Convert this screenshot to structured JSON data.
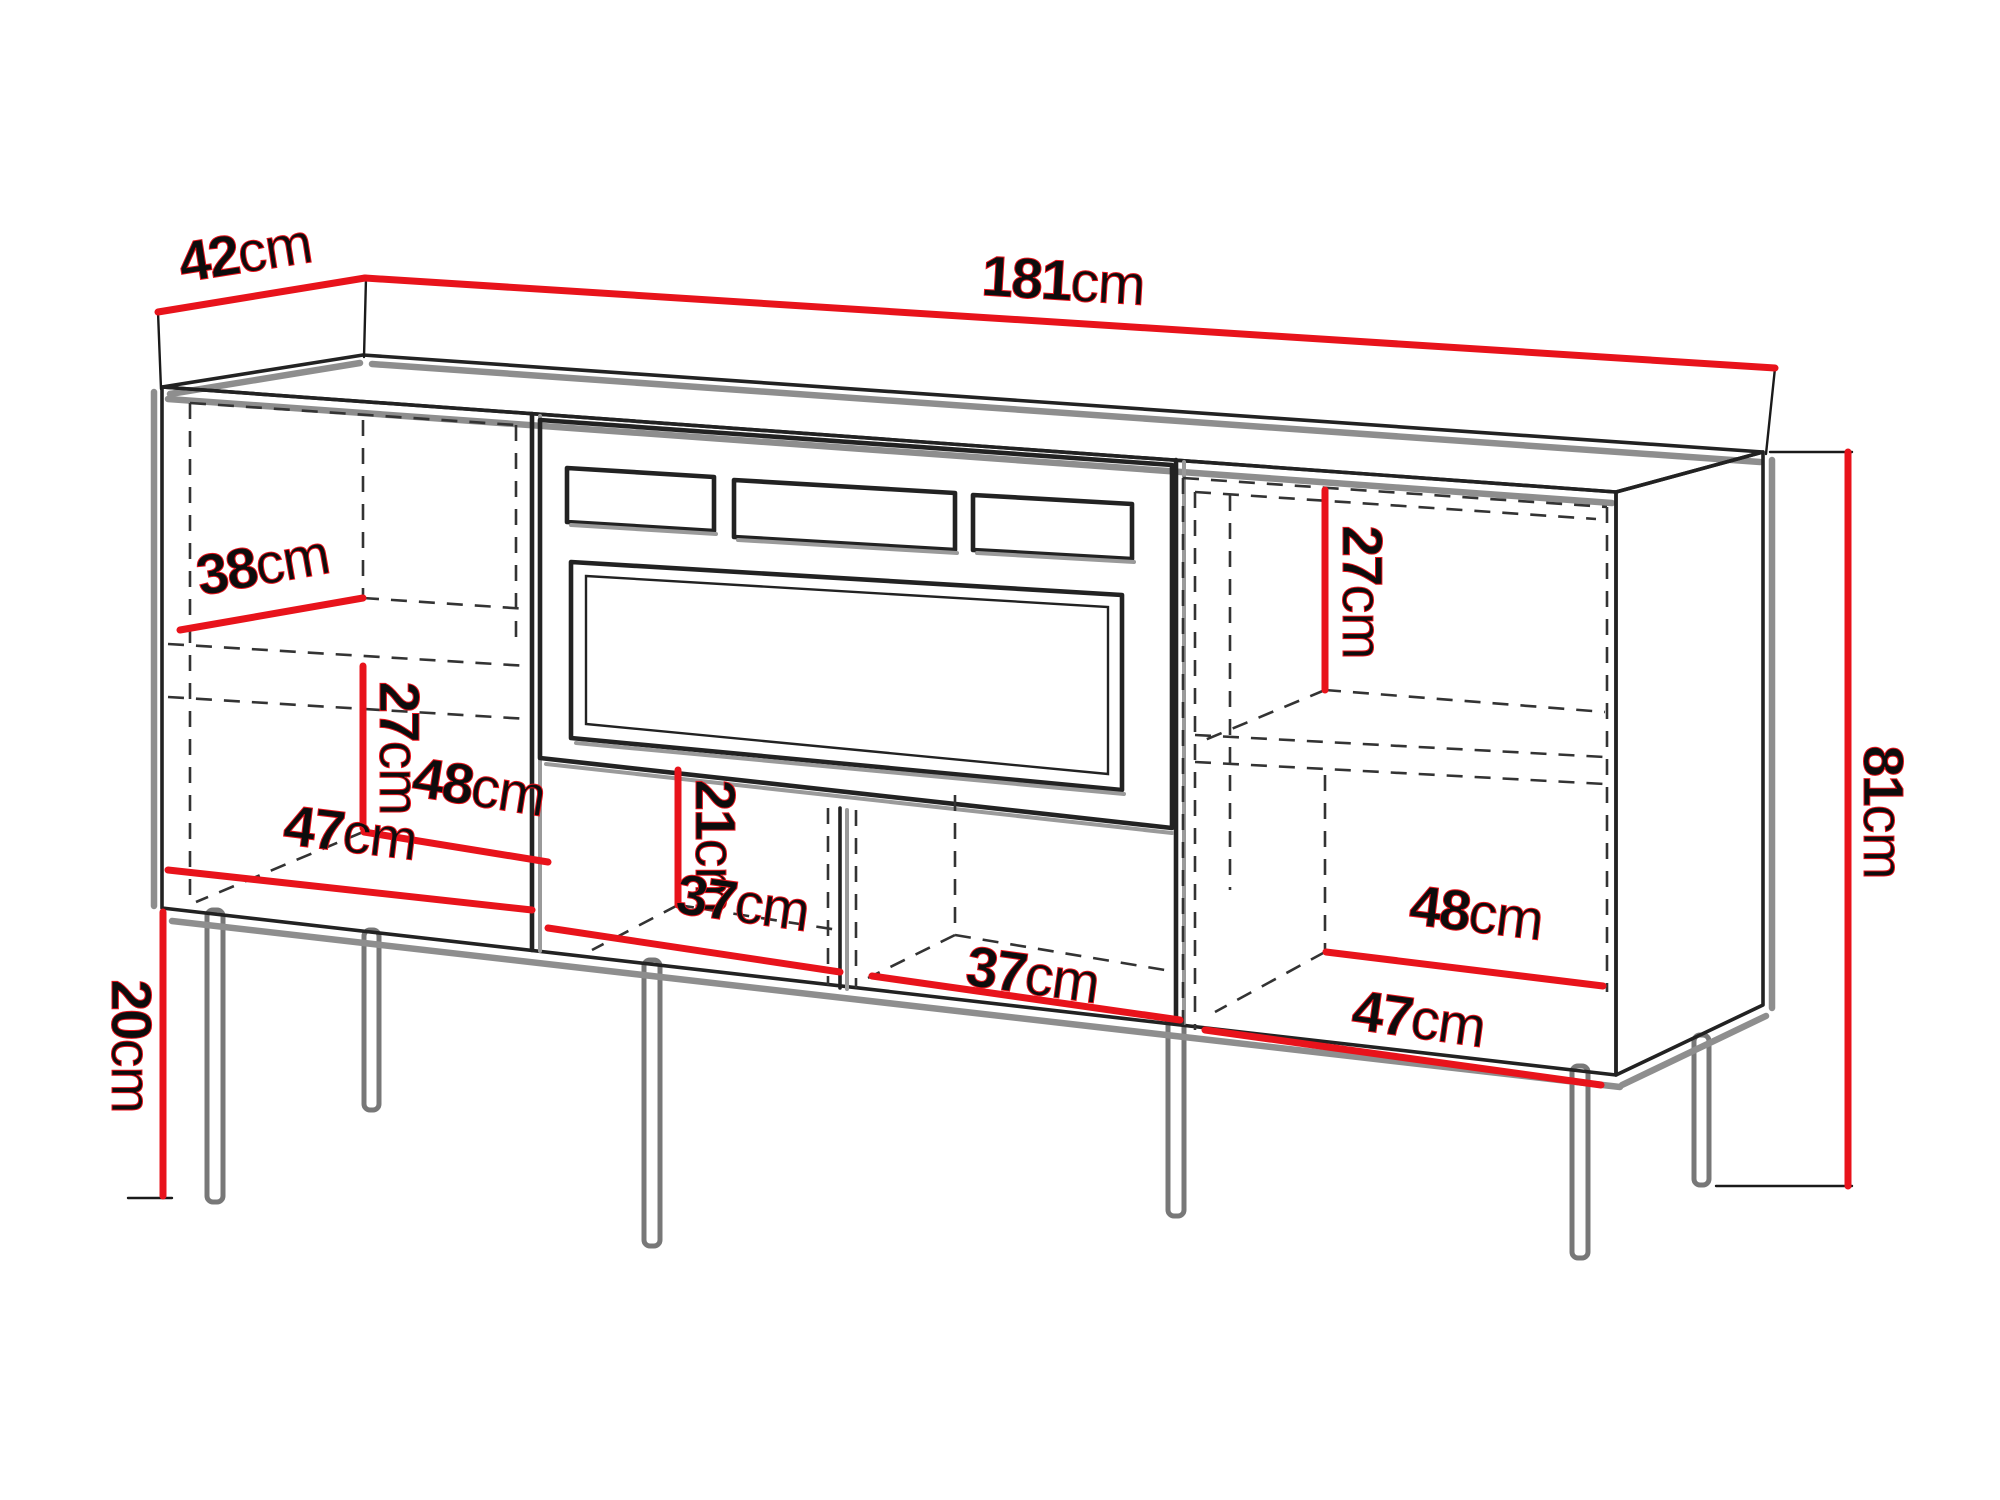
{
  "diagram": {
    "title": "Furniture dimension diagram",
    "furniture": "TV cabinet / sideboard with fireplace recess, two side cabinets, open shelves and six legs",
    "unit": "cm",
    "colors": {
      "dimension_line": "#e8131b",
      "outline": "#222222",
      "shadow": "#8e8e8e",
      "dashed": "#333333",
      "text": "#0d0d0d",
      "background": "#ffffff"
    },
    "dimensions": {
      "depth": {
        "number": "42",
        "unit": "cm",
        "meaning": "overall depth (top left edge)"
      },
      "width": {
        "number": "181",
        "unit": "cm",
        "meaning": "overall width (top edge)"
      },
      "height": {
        "number": "81",
        "unit": "cm",
        "meaning": "overall height (right side)"
      },
      "leg_height": {
        "number": "20",
        "unit": "cm",
        "meaning": "leg height (bottom left)"
      },
      "left_shelf_depth": {
        "number": "38",
        "unit": "cm",
        "meaning": "left cabinet shelf depth"
      },
      "left_lower_height": {
        "number": "27",
        "unit": "cm",
        "meaning": "left cabinet lower compartment height"
      },
      "left_lower_width": {
        "number": "48",
        "unit": "cm",
        "meaning": "left cabinet lower compartment width"
      },
      "left_floor_depth": {
        "number": "47",
        "unit": "cm",
        "meaning": "left cabinet floor depth"
      },
      "middle_lower_height": {
        "number": "21",
        "unit": "cm",
        "meaning": "middle open shelf height"
      },
      "middle_left_width": {
        "number": "37",
        "unit": "cm",
        "meaning": "middle left open shelf width"
      },
      "middle_right_width": {
        "number": "37",
        "unit": "cm",
        "meaning": "middle right open shelf width"
      },
      "right_upper_height": {
        "number": "27",
        "unit": "cm",
        "meaning": "right cabinet upper compartment height"
      },
      "right_lower_width": {
        "number": "48",
        "unit": "cm",
        "meaning": "right cabinet lower compartment width"
      },
      "right_floor_depth": {
        "number": "47",
        "unit": "cm",
        "meaning": "right cabinet floor depth"
      }
    }
  }
}
